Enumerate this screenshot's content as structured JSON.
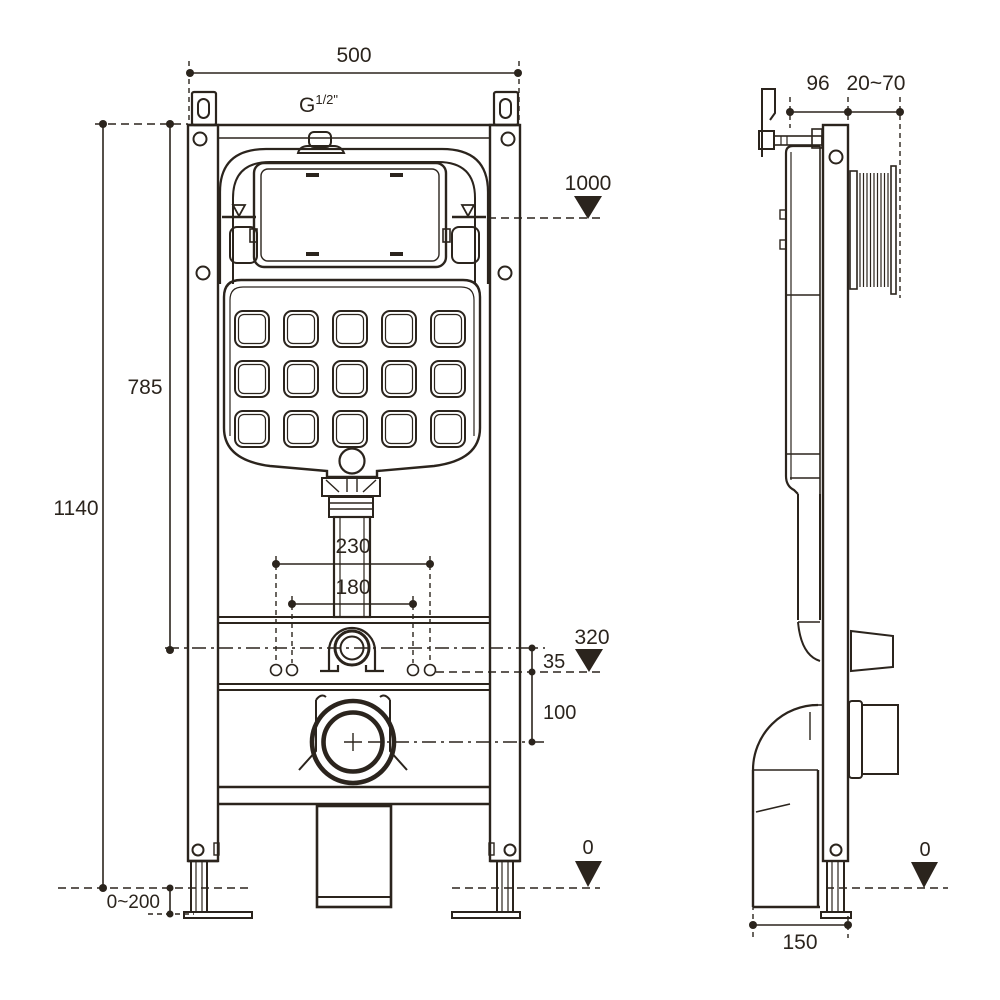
{
  "drawing": {
    "line_color": "#2b241d",
    "background": "#ffffff",
    "front_view": {
      "frame_width": "500",
      "total_height": "1140",
      "upper_height": "785",
      "inlet_thread": "G",
      "inlet_thread_size": "1/2\"",
      "flush_panel_level": "1000",
      "fixing_span_outer": "230",
      "fixing_span_inner": "180",
      "outlet_level": "320",
      "offset_small": "35",
      "offset_large": "100",
      "leg_adjust_range": "0~200",
      "floor_level": "0"
    },
    "side_view": {
      "frame_depth": "96",
      "wall_distance_range": "20~70",
      "floor_level": "0",
      "base_depth": "150"
    }
  }
}
